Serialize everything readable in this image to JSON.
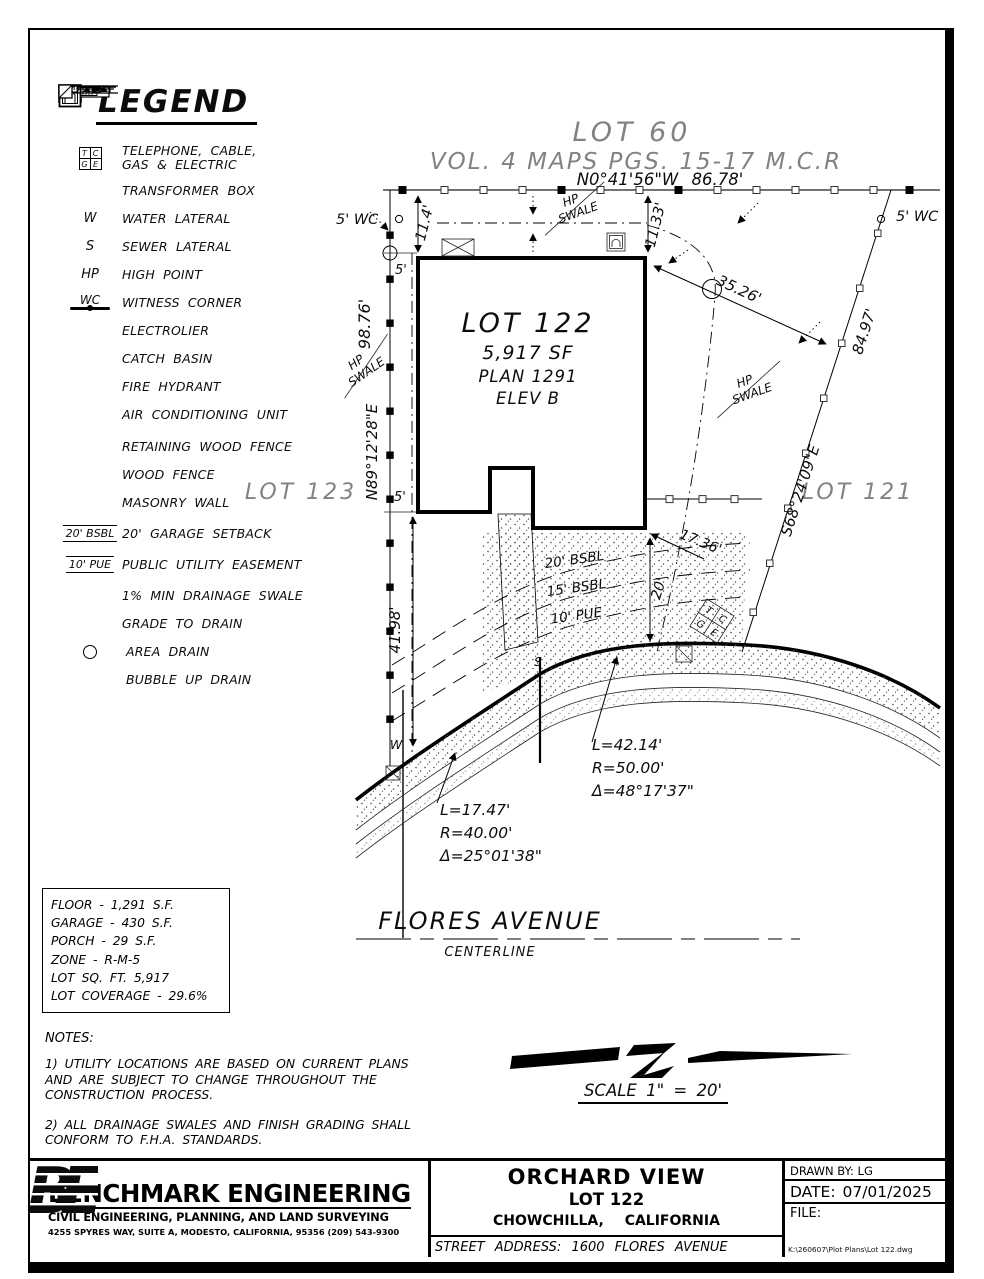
{
  "colors": {
    "ink": "#000000",
    "gray": "#828282",
    "blue": "#1b57a5"
  },
  "legend": {
    "title": "LEGEND",
    "tcge": {
      "t": "T",
      "c": "C",
      "g": "G",
      "e": "E"
    },
    "items": [
      {
        "label": "TELEPHONE, CABLE, GAS & ELECTRIC"
      },
      {
        "label": "TRANSFORMER BOX"
      },
      {
        "sym": "W",
        "label": "WATER LATERAL"
      },
      {
        "sym": "S",
        "label": "SEWER LATERAL"
      },
      {
        "sym": "HP",
        "label": "HIGH POINT"
      },
      {
        "sym": "WC",
        "label": "WITNESS CORNER"
      },
      {
        "label": "ELECTROLIER"
      },
      {
        "label": "CATCH BASIN"
      },
      {
        "label": "FIRE HYDRANT"
      },
      {
        "label": "AIR CONDITIONING UNIT"
      },
      {
        "label": "RETAINING WOOD FENCE"
      },
      {
        "label": "WOOD FENCE"
      },
      {
        "label": "MASONRY WALL"
      },
      {
        "sym": "20' BSBL",
        "label": "20' GARAGE SETBACK"
      },
      {
        "sym": "10' PUE",
        "label": "PUBLIC UTILITY EASEMENT"
      },
      {
        "label": "1% MIN DRAINAGE SWALE"
      },
      {
        "label": "GRADE TO DRAIN"
      },
      {
        "label": "AREA DRAIN"
      },
      {
        "label": "BUBBLE UP DRAIN"
      }
    ]
  },
  "plan": {
    "adjacent_lot_top": "LOT 60",
    "map_ref": "VOL. 4 MAPS PGS. 15-17 M.C.R",
    "bearing_top": "N0°41'56\"W  86.78'",
    "wc": "5' WC",
    "dim_11_4": "11.4'",
    "dim_11_33": "11.33'",
    "dim_5": "5'",
    "dim_98_76": "98.76'",
    "bearing_west": "N89°12'28\"E",
    "hp": "HP",
    "swale": "SWALE",
    "lot_name": "LOT 122",
    "lot_area": "5,917 SF",
    "lot_plan": "PLAN 1291",
    "lot_elev": "ELEV B",
    "adjacent_lot_left": "LOT 123",
    "adjacent_lot_right": "LOT 121",
    "dim_35_26": "35.26'",
    "dim_84_97": "84.97'",
    "bearing_east": "S68°24'09\"E",
    "dim_17_36": "17.36'",
    "dim_20": "20'",
    "dim_41_98": "41.98'",
    "bsbl_20": "20' BSBL",
    "bsbl_15": "15' BSBL",
    "pue_10": "10' PUE",
    "water": "W",
    "sewer": "S",
    "curve_right": {
      "l": "L=42.14'",
      "r": "R=50.00'",
      "d": "Δ=48°17'37\""
    },
    "curve_left": {
      "l": "L=17.47'",
      "r": "R=40.00'",
      "d": "Δ=25°01'38\""
    },
    "street_name": "FLORES AVENUE",
    "street_sub": "CENTERLINE"
  },
  "stats": {
    "rows": [
      "FLOOR - 1,291 S.F.",
      "GARAGE - 430 S.F.",
      "PORCH - 29 S.F.",
      "ZONE - R-M-5",
      "LOT SQ. FT. 5,917",
      "LOT COVERAGE - 29.6%"
    ]
  },
  "notes": {
    "title": "NOTES:",
    "note1": [
      "1) UTILITY LOCATIONS ARE BASED ON CURRENT PLANS",
      "AND ARE SUBJECT TO CHANGE THROUGHOUT THE",
      "CONSTRUCTION PROCESS."
    ],
    "note2": [
      "2) ALL DRAINAGE SWALES AND FINISH GRADING SHALL",
      "CONFORM TO F.H.A. STANDARDS."
    ]
  },
  "scale": {
    "label": "SCALE  1\" = 20'"
  },
  "titleblock": {
    "firm": {
      "logo_b": "B",
      "logo_e": "E",
      "name": "BENCHMARK ENGINEERING",
      "tagline": "CIVIL ENGINEERING, PLANNING, AND LAND SURVEYING",
      "address": "4255 SPYRES WAY, SUITE A, MODESTO, CALIFORNIA, 95356    (209) 543-9300"
    },
    "project": {
      "title": "ORCHARD VIEW",
      "lot": "LOT 122",
      "city": "CHOWCHILLA,    CALIFORNIA",
      "street": "STREET    ADDRESS:  1600  FLORES  AVENUE"
    },
    "meta": {
      "drawn_by": "DRAWN BY: LG",
      "date": "DATE:  07/01/2025",
      "file_label": "FILE:",
      "file_path": "K:\\260607\\Plot Plans\\Lot 122.dwg"
    }
  }
}
